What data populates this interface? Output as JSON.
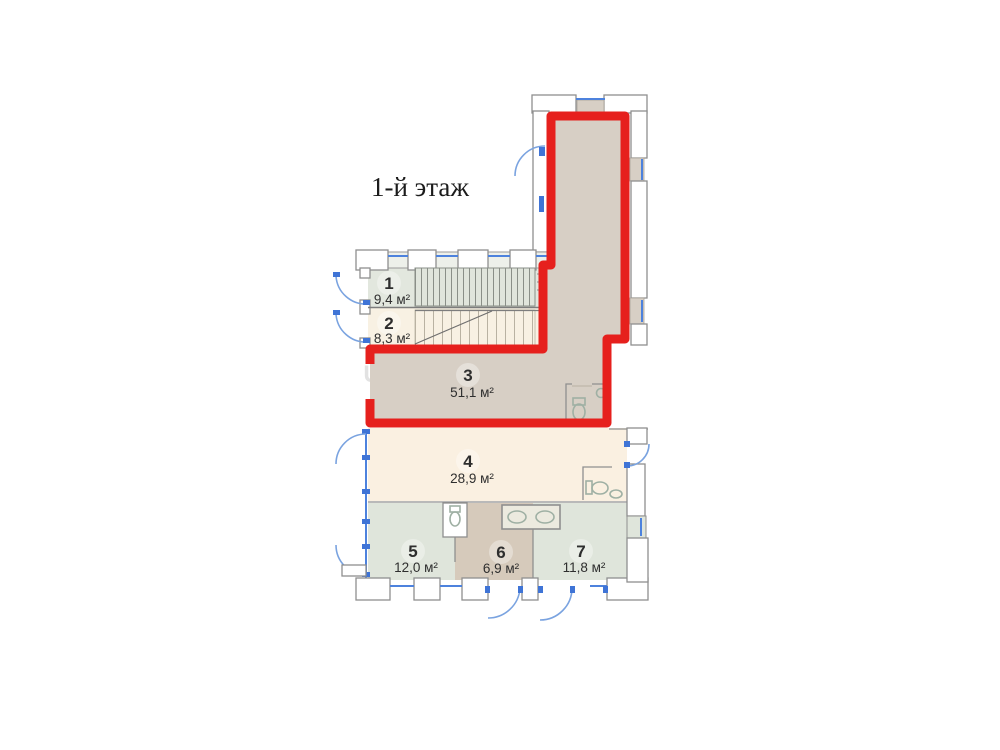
{
  "title": "1-й этаж",
  "watermark": {
    "main": "S5D.RU",
    "fragment": "U"
  },
  "rooms": [
    {
      "number": "1",
      "area": "9,4 м²"
    },
    {
      "number": "2",
      "area": "8,3 м²"
    },
    {
      "number": "3",
      "area": "51,1 м²"
    },
    {
      "number": "4",
      "area": "28,9 м²"
    },
    {
      "number": "5",
      "area": "12,0 м²"
    },
    {
      "number": "6",
      "area": "6,9 м²"
    },
    {
      "number": "7",
      "area": "11,8 м²"
    }
  ],
  "colors": {
    "highlight_outline": "#e6201d",
    "highlighted_unit_fill": "#d7cfc5",
    "cream_room_fill": "#f8f1e3",
    "green_room_fill": "#dfe5db",
    "brown_room_fill": "#d6cabb",
    "wall_stroke": "#8f8f8f",
    "glazing_blue": "#4d82dd"
  }
}
